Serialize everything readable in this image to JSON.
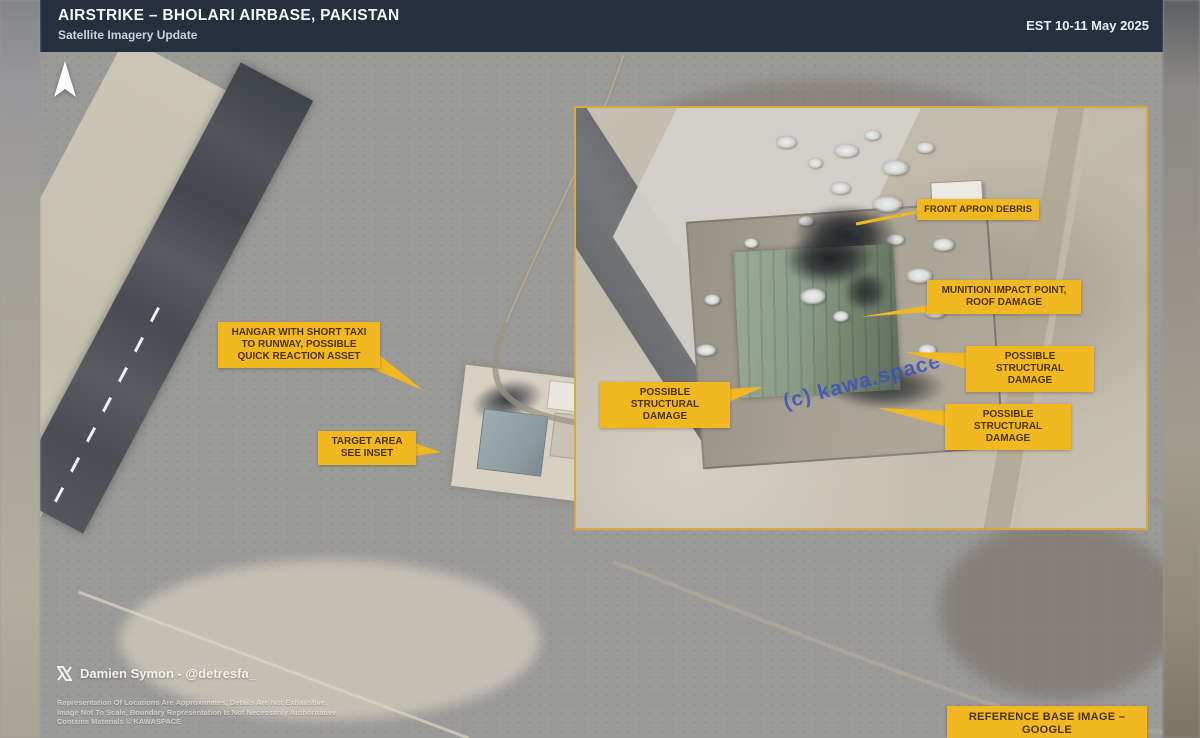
{
  "header": {
    "title": "AIRSTRIKE – BHOLARI AIRBASE, PAKISTAN",
    "subtitle": "Satellite Imagery Update",
    "date_estimate": "EST 10-11 May 2025"
  },
  "annotations": {
    "hangar": "HANGAR WITH SHORT TAXI\nTO RUNWAY, POSSIBLE\nQUICK REACTION ASSET",
    "target_area": "TARGET AREA\nSEE INSET",
    "front_apron": "FRONT APRON DEBRIS",
    "munition": "MUNITION IMPACT POINT,\nROOF DAMAGE",
    "structural_left": "POSSIBLE STRUCTURAL\nDAMAGE",
    "structural_right": "POSSIBLE STRUCTURAL\nDAMAGE",
    "structural_bottom": "POSSIBLE STRUCTURAL\nDAMAGE"
  },
  "watermark": {
    "text": "(c) kawa.space"
  },
  "credits": {
    "author": "Damien Symon - @detresfa_"
  },
  "disclaimer": {
    "lines": [
      "Representation Of Locations Are Approximates, Details Are Not Exhaustive,",
      "Image Not To Scale, Boundary Representation Is Not Necessarily Authoritative",
      "Contains Materials © KAWASPACE"
    ]
  },
  "footer": {
    "reference": "REFERENCE BASE IMAGE – GOOGLE"
  },
  "icons": {
    "north_arrow": "north-arrow-icon",
    "x_logo": "x-logo-icon"
  },
  "colors": {
    "accent_yellow": "#F2B822",
    "inset_border": "#D9A93C",
    "header_bg": "#262F3E",
    "callout_text": "#4A3403",
    "watermark_blue": "#3752BE"
  }
}
